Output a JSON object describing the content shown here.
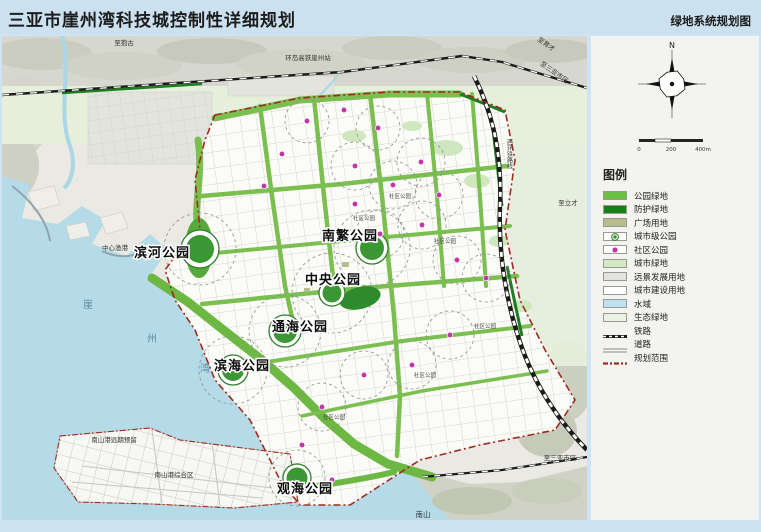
{
  "header": {
    "title": "三亚市崖州湾科技城控制性详细规划",
    "map_name": "绿地系统规划图"
  },
  "map": {
    "parks": [
      {
        "name": "滨河公园"
      },
      {
        "name": "南繁公园"
      },
      {
        "name": "中央公园"
      },
      {
        "name": "通海公园"
      },
      {
        "name": "滨海公园"
      },
      {
        "name": "观海公园"
      }
    ],
    "labels": {
      "to_baogu": "至抱古",
      "station": "环岛高铁崖州站",
      "to_yucai": "至育才",
      "to_sanya_top": "至三亚市区",
      "to_licai": "至立才",
      "to_sanya_bottom": "至三亚市区",
      "west_rail_line": "西环铁路线",
      "nanshan": "南山",
      "port_reserve": "南山港远期预留",
      "port_complex": "南山港综合区",
      "fishing_port": "中心渔港",
      "bay_char_1": "崖",
      "bay_char_2": "州",
      "bay_char_3": "湾",
      "community_park": "社区公园"
    },
    "compass": {
      "north": "N"
    },
    "scale": {
      "t0": "0",
      "t1": "200",
      "t2": "400m"
    }
  },
  "legend": {
    "title": "图例",
    "items": [
      {
        "label": "公园绿地",
        "type": "swatch",
        "color": "#6cbe45"
      },
      {
        "label": "防护绿地",
        "type": "swatch",
        "color": "#158015"
      },
      {
        "label": "广场用地",
        "type": "swatch",
        "color": "#b9bd8e"
      },
      {
        "label": "城市级公园",
        "type": "city_park",
        "color": "#2f7d2f"
      },
      {
        "label": "社区公园",
        "type": "community_park",
        "color": "#c335a8"
      },
      {
        "label": "城市绿地",
        "type": "swatch",
        "color": "#d3e8c3"
      },
      {
        "label": "远景发展用地",
        "type": "swatch",
        "color": "#e2e2df"
      },
      {
        "label": "城市建设用地",
        "type": "swatch",
        "color": "#ffffff"
      },
      {
        "label": "水域",
        "type": "swatch",
        "color": "#bfe1ee"
      },
      {
        "label": "生态绿地",
        "type": "swatch",
        "color": "#eaf3e3"
      },
      {
        "label": "铁路",
        "type": "railway",
        "color": "#1a1a1a"
      },
      {
        "label": "道路",
        "type": "road",
        "color": "#8a8a8a"
      },
      {
        "label": "规划范围",
        "type": "boundary",
        "color": "#9e2b1f"
      }
    ]
  }
}
